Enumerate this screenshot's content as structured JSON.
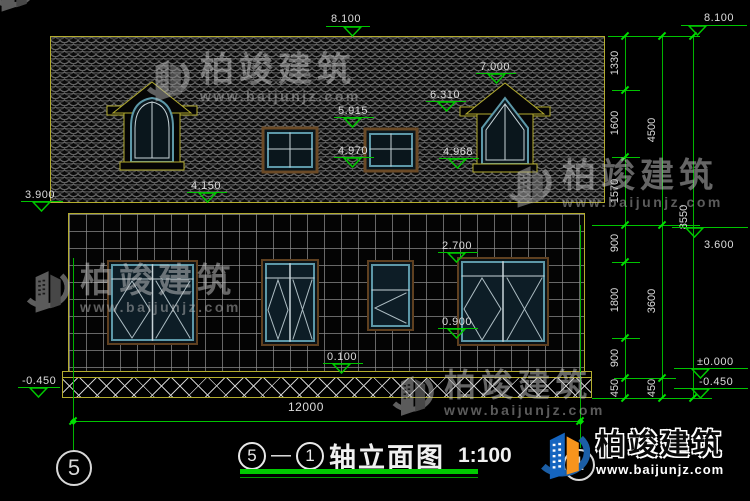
{
  "title": {
    "axis_from": "5",
    "dash": "—",
    "axis_to": "1",
    "name": "轴立面图",
    "scale": "1:100"
  },
  "axes": {
    "left": "5",
    "right": "1"
  },
  "brand": {
    "name": "柏竣建筑",
    "site": "www.baijunjz.com"
  },
  "elevations": {
    "ridge_center": "8.100",
    "ridge_right": "8.100",
    "dormer_peak": "7.000",
    "dormer_eave": "6.310",
    "roof_window_top": "5.915",
    "roof_window_bottom": "4.970",
    "dormer_window_bottom": "4.968",
    "eave_center": "4.150",
    "eave_left": "3.900",
    "wall_top_right": "3.600",
    "window_top": "2.700",
    "window_bottom": "0.900",
    "plinth": "0.100",
    "ground_zero": "±0.000",
    "ground_right": "-0.450",
    "ground_left": "-0.450"
  },
  "dimensions": {
    "right_inner": [
      "1330",
      "1600",
      "1570",
      "900",
      "1800",
      "900",
      "450"
    ],
    "right_mid": [
      "4500",
      "3600",
      "450"
    ],
    "right_outer": [
      "8550"
    ],
    "bottom": "12000"
  }
}
